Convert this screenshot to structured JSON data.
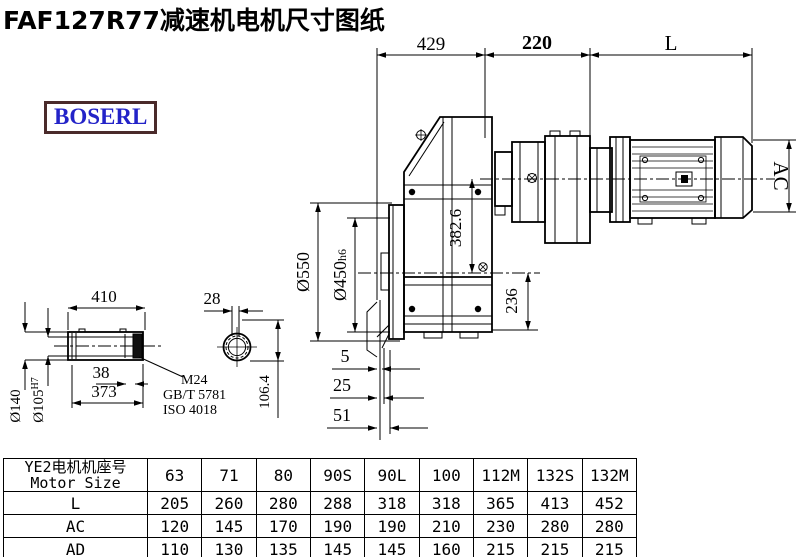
{
  "title": "FAF127R77减速机电机尺寸图纸",
  "logo": "BOSERL",
  "colors": {
    "line": "#000000",
    "logo_text": "#2323c8",
    "logo_border": "#4a2a2a",
    "background": "#ffffff"
  },
  "labels": {
    "d429": "429",
    "d220": "220",
    "dL": "L",
    "dAC": "AC",
    "d550": "Ø550",
    "d450": "Ø450",
    "d450_suffix": "h6",
    "d382": "382.6",
    "d236": "236",
    "d5": "5",
    "d25": "25",
    "d51": "51",
    "d410": "410",
    "d28": "28",
    "d38": "38",
    "d373": "373",
    "d140": "Ø140",
    "d105": "Ø105",
    "d105_sup": "H7",
    "d106": "106.4",
    "note_m24": "M24",
    "note_gbt": "GB/T 5781",
    "note_iso": "ISO 4018"
  },
  "table": {
    "header_cn": "YE2电机机座号",
    "header_en": "Motor Size",
    "columns": [
      "63",
      "71",
      "80",
      "90S",
      "90L",
      "100",
      "112M",
      "132S",
      "132M"
    ],
    "rows": [
      {
        "label": "L",
        "values": [
          "205",
          "260",
          "280",
          "288",
          "318",
          "318",
          "365",
          "413",
          "452"
        ]
      },
      {
        "label": "AC",
        "values": [
          "120",
          "145",
          "170",
          "190",
          "190",
          "210",
          "230",
          "280",
          "280"
        ]
      },
      {
        "label": "AD",
        "values": [
          "110",
          "130",
          "135",
          "145",
          "145",
          "160",
          "215",
          "215",
          "215"
        ]
      }
    ]
  }
}
